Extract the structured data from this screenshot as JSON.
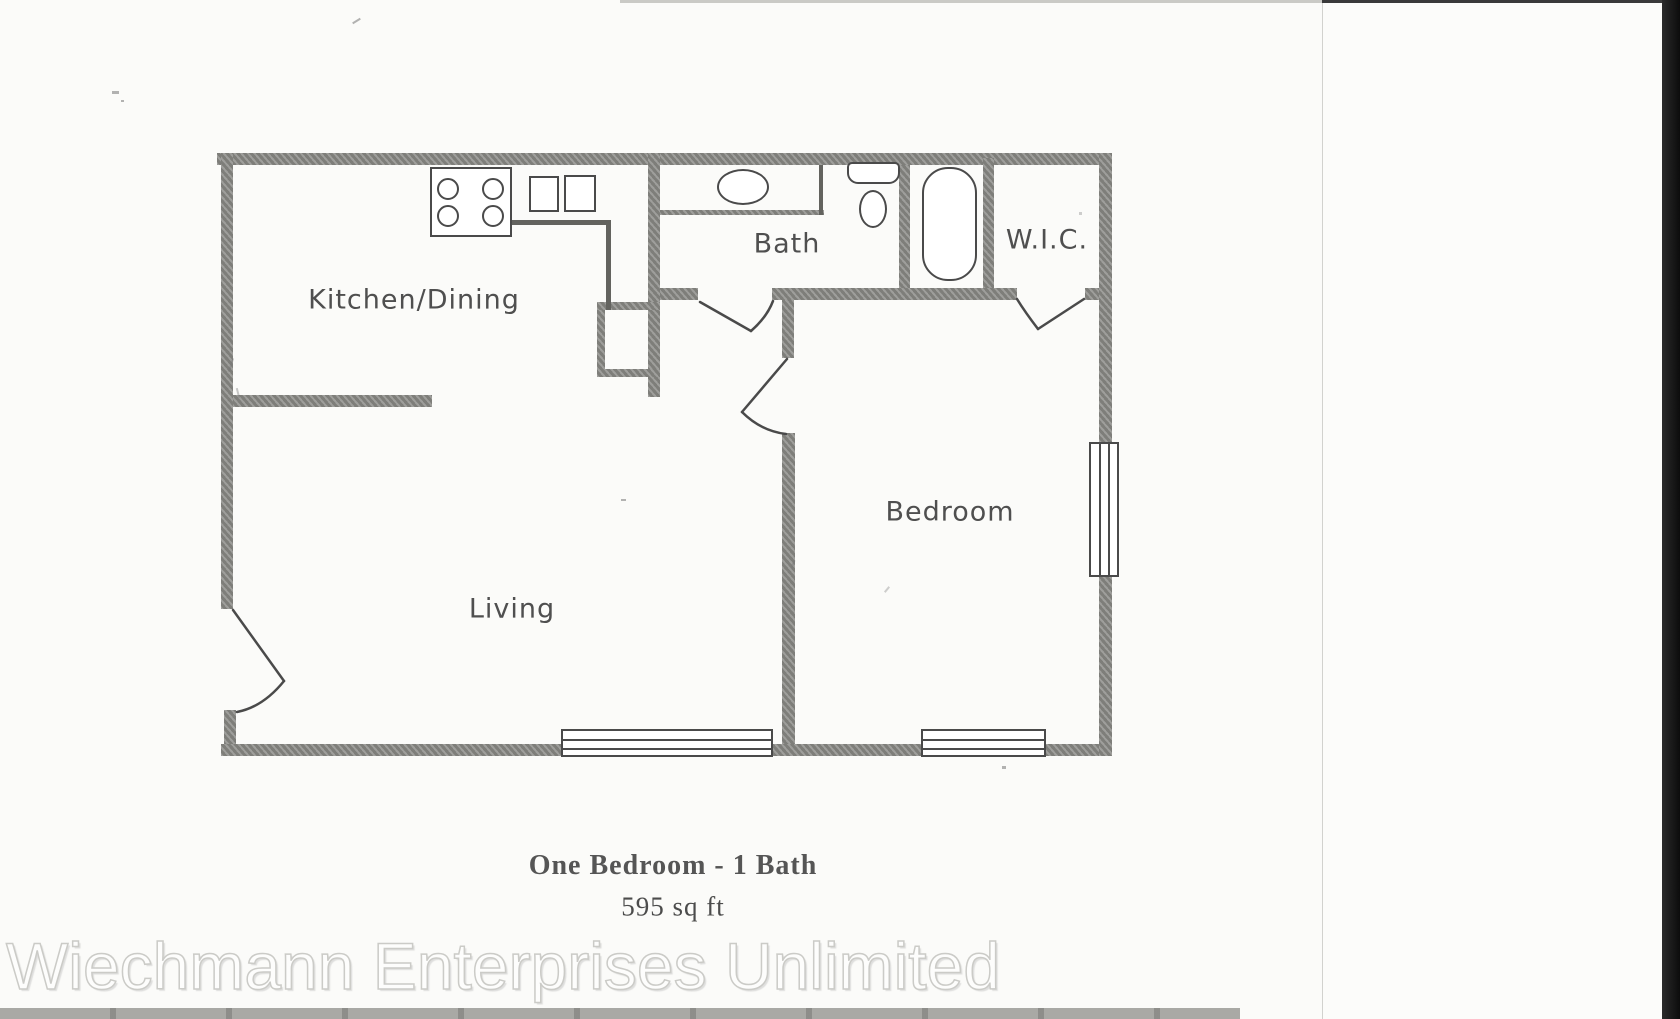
{
  "rooms": {
    "kitchen": {
      "label": "Kitchen/Dining"
    },
    "bath": {
      "label": "Bath"
    },
    "wic": {
      "label": "W.I.C."
    },
    "bedroom": {
      "label": "Bedroom"
    },
    "living": {
      "label": "Living"
    }
  },
  "caption": {
    "title": "One Bedroom - 1 Bath",
    "area": "595 sq ft"
  },
  "watermark": {
    "text": "Wiechmann Enterprises Unlimited"
  },
  "fixtures": [
    "stove-burners",
    "kitchen-sink-basins",
    "vanity-sink",
    "toilet",
    "bathtub",
    "window",
    "door-swing"
  ],
  "colors": {
    "wall": "#8c8c88",
    "line": "#4a4a4a",
    "paper": "#fbfbf9",
    "bottom_band": "#a9a9a5",
    "watermark_stroke": "#cbcbc7"
  }
}
